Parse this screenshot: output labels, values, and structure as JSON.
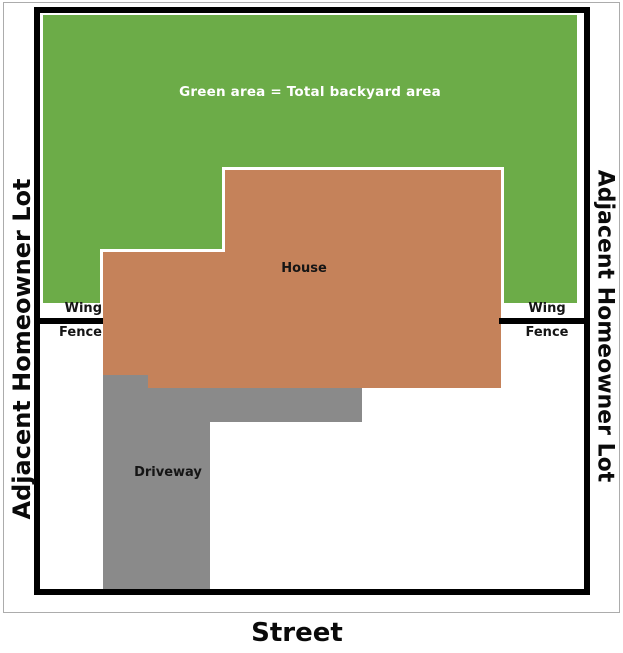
{
  "diagram": {
    "title_note": "Property lot plan",
    "backyard": {
      "label": "Green area = Total backyard area"
    },
    "house": {
      "label": "House"
    },
    "driveway": {
      "label": "Driveway"
    },
    "street": {
      "label": "Street"
    },
    "adjacent_lot_left": {
      "label": "Adjacent Homeowner Lot"
    },
    "adjacent_lot_right": {
      "label": "Adjacent Homeowner Lot"
    },
    "wing_fence_left": {
      "wing": "Wing",
      "fence": "Fence"
    },
    "wing_fence_right": {
      "wing": "Wing",
      "fence": "Fence"
    }
  },
  "colors": {
    "backyard": "#6cac48",
    "house": "#c5825a",
    "driveway": "#8a8a8a",
    "boundary": "#000000",
    "frame": "#acacac"
  }
}
